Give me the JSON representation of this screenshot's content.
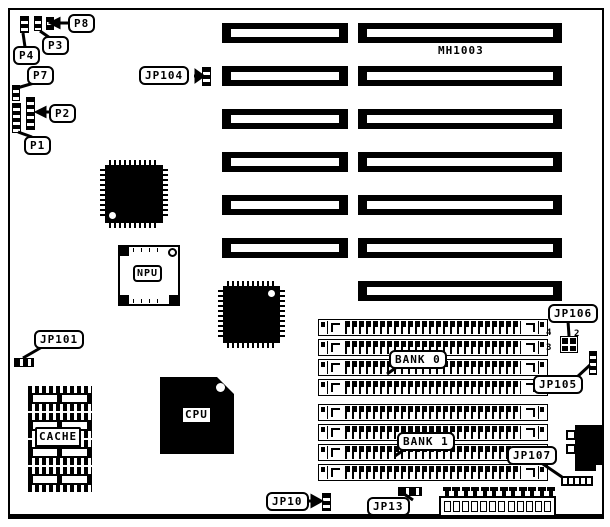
{
  "board": {
    "chip_marking": "MH1003",
    "callouts": {
      "p8": "P8",
      "p3": "P3",
      "p4": "P4",
      "p7": "P7",
      "p2": "P2",
      "p1": "P1",
      "jp104": "JP104",
      "jp101": "JP101",
      "jp106": "JP106",
      "jp105": "JP105",
      "jp107": "JP107",
      "jp10": "JP10",
      "jp13": "JP13",
      "bank0": "BANK 0",
      "bank1": "BANK 1"
    },
    "chip_labels": {
      "cpu": "CPU",
      "npu": "NPU",
      "cache": "CACHE"
    },
    "jp106_pins": {
      "top_left": "4",
      "top_right": "2",
      "bottom_left": "3"
    },
    "colors": {
      "ink": "#000000",
      "paper": "#ffffff"
    },
    "isa_slots_left_column": 6,
    "isa_slots_right_column": 7,
    "simm_sockets_per_bank": 4
  }
}
